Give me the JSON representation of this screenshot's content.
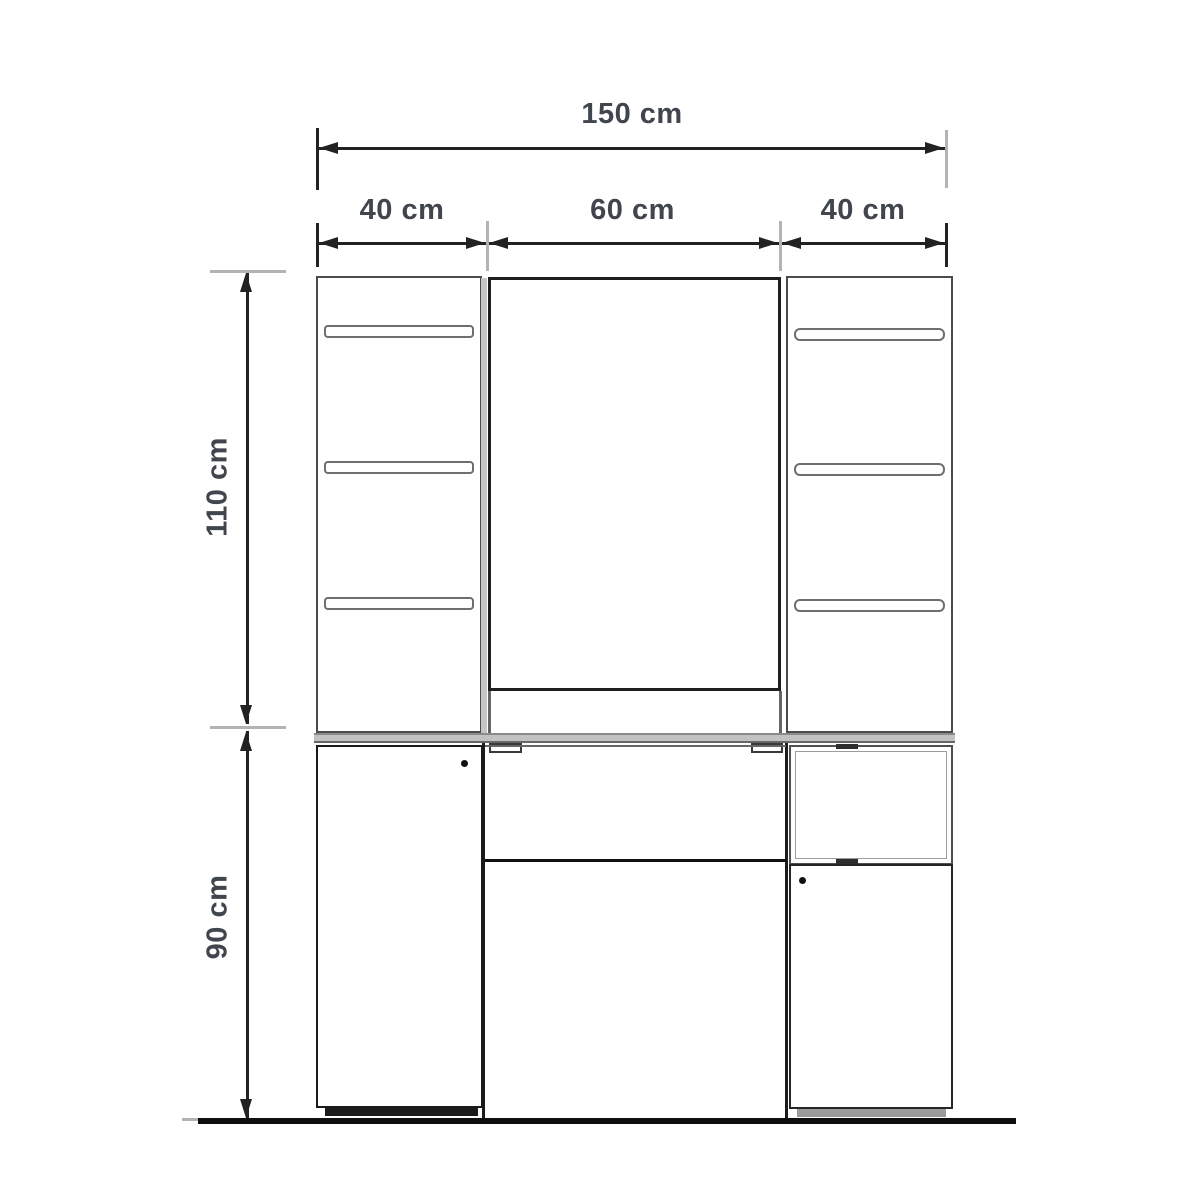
{
  "diagram": {
    "title": "Cabinet / dressing table front elevation drawing",
    "units": "cm",
    "total_width": {
      "value": 150,
      "label": "150 cm"
    },
    "sections": [
      {
        "name": "left-column-width",
        "value": 40,
        "label": "40 cm"
      },
      {
        "name": "middle-mirror-width",
        "value": 60,
        "label": "60 cm"
      },
      {
        "name": "right-column-width",
        "value": 40,
        "label": "40 cm"
      }
    ],
    "upper_height": {
      "value": 110,
      "label": "110 cm"
    },
    "lower_height": {
      "value": 90,
      "label": "90 cm"
    },
    "colors": {
      "line": "#222222",
      "panel_border": "#4b4b4b",
      "gray_tick": "#b3b3b3",
      "worktop": "#c2c2c2",
      "text": "#41454d",
      "background": "#ffffff"
    }
  }
}
